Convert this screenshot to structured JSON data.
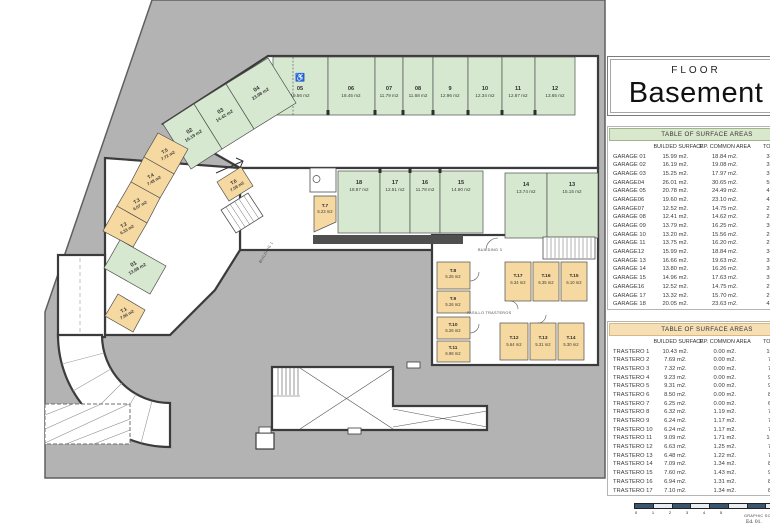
{
  "title_block": {
    "floor": "FLOOR",
    "name": "Basement"
  },
  "plan": {
    "wheelchair_icon": "♿",
    "top_row": [
      {
        "id": "05",
        "area": "19.56 m2"
      },
      {
        "id": "06",
        "area": "18.45 m2"
      },
      {
        "id": "07",
        "area": "11.79 m2"
      },
      {
        "id": "08",
        "area": "11.68 m2"
      },
      {
        "id": "9",
        "area": "12.96 m2"
      },
      {
        "id": "10",
        "area": "12.34 m2"
      },
      {
        "id": "11",
        "area": "12.87 m2"
      },
      {
        "id": "12",
        "area": "13.65 m2"
      }
    ],
    "diagonal": [
      {
        "id": "04",
        "area": "23.98 m2"
      },
      {
        "id": "03",
        "area": "14.42 m2"
      },
      {
        "id": "02",
        "area": "16.19 m2"
      }
    ],
    "stall01": {
      "id": "01",
      "area": "13.68 m2"
    },
    "middle_row": [
      {
        "id": "18",
        "area": "18.87 m2"
      },
      {
        "id": "17",
        "area": "12.51 m2"
      },
      {
        "id": "16",
        "area": "11.78 m2"
      },
      {
        "id": "15",
        "area": "14.90 m2"
      }
    ],
    "right_pair": [
      {
        "id": "14",
        "area": "13.74 m2"
      },
      {
        "id": "13",
        "area": "15.15 m2"
      }
    ],
    "left_trasteros": [
      {
        "id": "T.5",
        "area": "7.72 m2"
      },
      {
        "id": "T.4",
        "area": "7.48 m2"
      },
      {
        "id": "T.3",
        "area": "6.07 m2"
      },
      {
        "id": "T.2",
        "area": "6.33 m2"
      }
    ],
    "t1": {
      "id": "T.1",
      "area": "7.96 m2"
    },
    "t6": {
      "id": "T.6",
      "area": "7.58 m2"
    },
    "t7": {
      "id": "T.7",
      "area": "5.23 m2"
    },
    "block_left": [
      {
        "id": "T.8",
        "area": "5.26 m2"
      },
      {
        "id": "T.9",
        "area": "5.26 m2"
      },
      {
        "id": "T.10",
        "area": "5.26 m2"
      },
      {
        "id": "T.11",
        "area": "6.98 m2"
      }
    ],
    "block_top": [
      {
        "id": "T.17",
        "area": "6.34 m2"
      },
      {
        "id": "T.16",
        "area": "6.35 m2"
      },
      {
        "id": "T.15",
        "area": "6.10 m2"
      }
    ],
    "block_bottom": [
      {
        "id": "T.12",
        "area": "5.64 m2"
      },
      {
        "id": "T.13",
        "area": "5.31 m2"
      },
      {
        "id": "T.14",
        "area": "5.30 m2"
      }
    ],
    "corridor_label": "PASILLO TRASTEROS",
    "building1": "BUILDING 1",
    "building3": "BUILDING 3"
  },
  "tables": {
    "garages": {
      "title": "TABLE OF SURFACE AREAS",
      "col_headers": [
        "BUILDED SURFACE",
        "P.P. COMMON AREA",
        "TOTAL AREA"
      ],
      "rows": [
        {
          "name": "GARAGE 01",
          "built": "15.99 m2.",
          "common": "18.84 m2.",
          "total": "34.83 m2."
        },
        {
          "name": "GARAGE 02",
          "built": "16.19 m2.",
          "common": "19.08 m2.",
          "total": "35.27 m2."
        },
        {
          "name": "GARAGE 03",
          "built": "15.25 m2.",
          "common": "17.97 m2.",
          "total": "33.22 m2."
        },
        {
          "name": "GARAGE04",
          "built": "26.01 m2.",
          "common": "30.65 m2.",
          "total": "56.66 m2."
        },
        {
          "name": "GARAGE 05",
          "built": "20.78 m2.",
          "common": "24.49 m2.",
          "total": "45.27 m2."
        },
        {
          "name": "GARAGE06",
          "built": "19.60 m2.",
          "common": "23.10 m2.",
          "total": "42.70 m2."
        },
        {
          "name": "GARAGE07",
          "built": "12.52 m2.",
          "common": "14.75 m2.",
          "total": "27.27 m2."
        },
        {
          "name": "GARAGE 08",
          "built": "12.41 m2.",
          "common": "14.62 m2.",
          "total": "27.03 m2."
        },
        {
          "name": "GARAGE 09",
          "built": "13.79 m2.",
          "common": "16.25 m2.",
          "total": "30.04 m2."
        },
        {
          "name": "GARAGE 10",
          "built": "13.20 m2.",
          "common": "15.56 m2.",
          "total": "28.76 m2."
        },
        {
          "name": "GARAGE 11",
          "built": "13.75 m2.",
          "common": "16.20 m2.",
          "total": "29.95 m2."
        },
        {
          "name": "GARAGE12",
          "built": "15.99 m2.",
          "common": "18.84 m2.",
          "total": "34.83 m2."
        },
        {
          "name": "GARAGE 13",
          "built": "16.66 m2.",
          "common": "19.63 m2.",
          "total": "36.29 m2."
        },
        {
          "name": "GARAGE 14",
          "built": "13.80 m2.",
          "common": "16.26 m2.",
          "total": "30.06 m2."
        },
        {
          "name": "GARAGE 15",
          "built": "14.96 m2.",
          "common": "17.63 m2.",
          "total": "32.59 m2."
        },
        {
          "name": "GARAGE16",
          "built": "12.52 m2.",
          "common": "14.75 m2.",
          "total": "27.27 m2."
        },
        {
          "name": "GARAGE 17",
          "built": "13.32 m2.",
          "common": "15.70 m2.",
          "total": "29.02 m2."
        },
        {
          "name": "GARAGE 18",
          "built": "20.05 m2.",
          "common": "23.63 m2.",
          "total": "43.68 m2."
        }
      ]
    },
    "trasteros": {
      "title": "TABLE OF SURFACE AREAS",
      "col_headers": [
        "BUILDED SURFACE",
        "P.P. COMMON AREA",
        "TOTAL AREA"
      ],
      "rows": [
        {
          "name": "TRASTERO 1",
          "built": "10.43 m2.",
          "common": "0.00 m2.",
          "total": "10.43 m2."
        },
        {
          "name": "TRASTERO 2",
          "built": "7.69 m2.",
          "common": "0.00 m2.",
          "total": "7.69 m2."
        },
        {
          "name": "TRASTERO 3",
          "built": "7.32 m2.",
          "common": "0.00 m2.",
          "total": "7.32 m2."
        },
        {
          "name": "TRASTERO 4",
          "built": "9.23 m2.",
          "common": "0.00 m2.",
          "total": "9.23 m2."
        },
        {
          "name": "TRASTERO 5",
          "built": "9.31 m2.",
          "common": "0.00 m2.",
          "total": "9.31 m2."
        },
        {
          "name": "TRASTERO 6",
          "built": "8.50 m2.",
          "common": "0.00 m2.",
          "total": "8.50 m2."
        },
        {
          "name": "TRASTERO 7",
          "built": "6.25 m2.",
          "common": "0.00 m2.",
          "total": "6.25 m2."
        },
        {
          "name": "TRASTERO 8",
          "built": "6.32 m2.",
          "common": "1.19 m2.",
          "total": "7.51 m2."
        },
        {
          "name": "TRASTERO 9",
          "built": "6.24 m2.",
          "common": "1.17 m2.",
          "total": "7.41 m2."
        },
        {
          "name": "TRASTERO 10",
          "built": "6.24 m2.",
          "common": "1.17 m2.",
          "total": "7.41 m2."
        },
        {
          "name": "TRASTERO 11",
          "built": "9.09 m2.",
          "common": "1.71 m2.",
          "total": "10.80 m2."
        },
        {
          "name": "TRASTERO 12",
          "built": "6.63 m2.",
          "common": "1.25 m2.",
          "total": "7.88 m2."
        },
        {
          "name": "TRASTERO 13",
          "built": "6.48 m2.",
          "common": "1.22 m2.",
          "total": "7.70 m2."
        },
        {
          "name": "TRASTERO 14",
          "built": "7.09 m2.",
          "common": "1.34 m2.",
          "total": "8.43 m2."
        },
        {
          "name": "TRASTERO 15",
          "built": "7.60 m2.",
          "common": "1.43 m2.",
          "total": "9.03 m2."
        },
        {
          "name": "TRASTERO 16",
          "built": "6.94 m2.",
          "common": "1.31 m2.",
          "total": "8.25 m2."
        },
        {
          "name": "TRASTERO 17",
          "built": "7.10 m2.",
          "common": "1.34 m2.",
          "total": "8.44 m2."
        }
      ]
    }
  },
  "scale_bar": {
    "labels": [
      "0",
      "1",
      "2",
      "3",
      "4",
      "5"
    ]
  },
  "footer": {
    "scale_note": "GRAPHIC SCALE",
    "edition": "Ed. 01."
  },
  "colors": {
    "site_gray": "#b3b3b3",
    "garage_green": "#d6e9d0",
    "trastero_orange": "#f6d9a0",
    "wall": "#3b3b3b",
    "garage_header": "#d9e7cc",
    "trastero_header": "#f7dfb5"
  }
}
